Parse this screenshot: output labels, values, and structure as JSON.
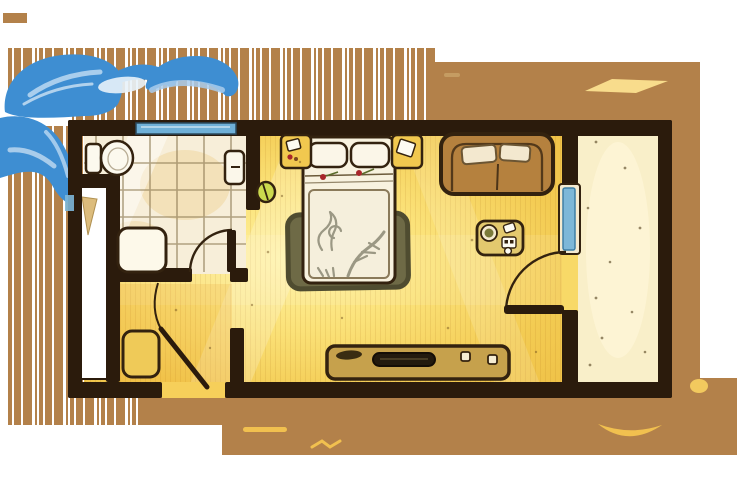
{
  "illustration": {
    "kind": "hand-drawn hotel room floor plan, top-down view, no text labels",
    "rooms": [
      {
        "id": "bathroom",
        "position": "top-left",
        "floor": "cream tiles with grid"
      },
      {
        "id": "closet",
        "position": "left edge",
        "floor": "white"
      },
      {
        "id": "entry-hall",
        "position": "bottom-left",
        "floor": "gold"
      },
      {
        "id": "bedroom-living",
        "position": "center",
        "floor": "gold gradient with light streaks"
      },
      {
        "id": "balcony",
        "position": "right strip",
        "floor": "speckled cream"
      }
    ],
    "furniture_icons": [
      "toilet-icon",
      "wall-sink-icon",
      "shower-tray-icon",
      "wardrobe-icon",
      "luggage-stool-icon",
      "double-bed-icon",
      "pillow-icon",
      "rose-icon",
      "nightstand-left-icon",
      "nightstand-right-icon",
      "area-rug-icon",
      "wall-lamp-icon",
      "sofa-icon",
      "sofa-cushion-icon",
      "coffee-table-icon",
      "tv-console-icon",
      "television-icon",
      "bathroom-window-icon",
      "glass-balcony-door-icon",
      "door-swing-arc-icon",
      "entry-door-icon",
      "blue-paint-swoosh-icon",
      "wood-grain-stripes-icon",
      "light-streak-icon"
    ]
  },
  "palette": {
    "page_white": "#ffffff",
    "mat_brown": "#b3814a",
    "wall_dark": "#2b1b0c",
    "outline_dark": "#33220f",
    "floor_gold": "#f3cb52",
    "floor_gold_bright": "#fff2a0",
    "tile_cream": "#f7eed9",
    "tile_line": "#93805a",
    "balcony_cream": "#f9efc9",
    "closet_white": "#ffffff",
    "glass_blue": "#7db7d8",
    "glass_blue_dark": "#3e7fa6",
    "window_blue": "#6fb0d8",
    "swoosh_blue": "#3e8ed2",
    "swoosh_blue_light": "#bcd9f2",
    "sofa_brown": "#b5813e",
    "cushion_cream": "#f3e8cf",
    "bed_white": "#f8f2df",
    "duvet_pattern_gray": "#85836f",
    "rug_olive": "#6e6a46",
    "furniture_yellow": "#f1c84f",
    "console_tan": "#c6a14c",
    "tv_dark": "#231a0e",
    "accent_rose": "#a8262a",
    "stem_green": "#5a6b2a",
    "plant_green": "#cbd94e",
    "streak_yellow": "#f1c04f",
    "flap_tan": "#dcbc7c"
  }
}
